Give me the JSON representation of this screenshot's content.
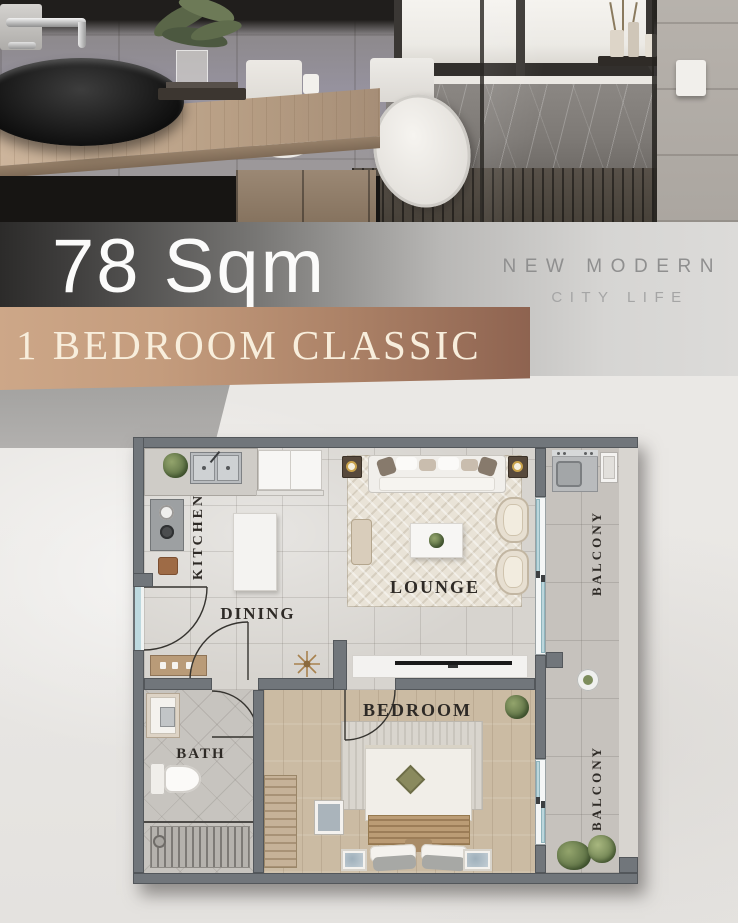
{
  "header": {
    "area": "78 Sqm",
    "tagline_line1": "NEW MODERN",
    "tagline_line2": "CITY LIFE"
  },
  "banner": {
    "title": "1 BEDROOM CLASSIC",
    "gradient_left": "#cda788",
    "gradient_right": "#8e6350",
    "text_color": "#f8eedc"
  },
  "floorplan": {
    "labels": {
      "kitchen": "KITCHEN",
      "dining": "DINING",
      "lounge": "LOUNGE",
      "bedroom": "BEDROOM",
      "bath": "BATH",
      "balcony_top": "BALCONY",
      "balcony_bottom": "BALCONY"
    },
    "colors": {
      "wall": "#71767b",
      "glass": "#bdd9df",
      "living_floor": "#d7d4cf",
      "bedroom_floor": "#cbbba3",
      "balcony_floor": "#c6c2bd"
    }
  }
}
